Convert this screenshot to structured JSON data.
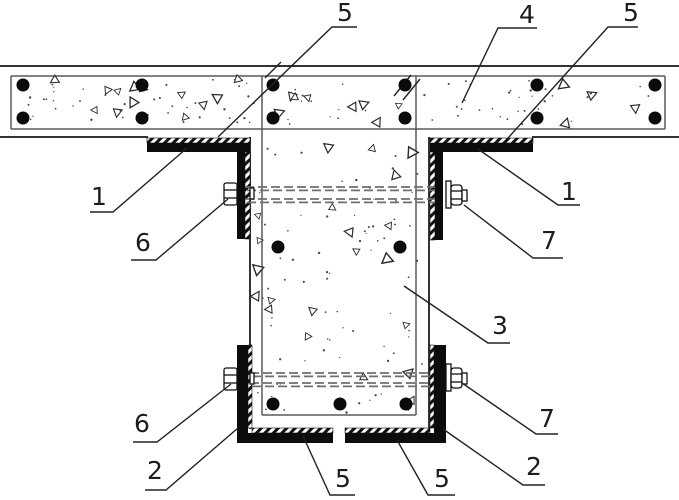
{
  "figure": {
    "kind": "patent-style structural cross-section drawing",
    "description_visible_parts": "T-joint of concrete slab and beam strengthened with steel angles, bottom channel, through-bolts and tie rods",
    "callouts": [
      {
        "label": "5",
        "tx": 345,
        "ty": 0,
        "pts": [
          [
            357,
            27
          ],
          [
            332,
            27
          ],
          [
            218,
            137
          ]
        ]
      },
      {
        "label": "4",
        "tx": 527,
        "ty": 2,
        "pts": [
          [
            537,
            28
          ],
          [
            498,
            28
          ],
          [
            462,
            103
          ]
        ]
      },
      {
        "label": "5",
        "tx": 631,
        "ty": 0,
        "pts": [
          [
            638,
            27
          ],
          [
            608,
            27
          ],
          [
            508,
            138
          ]
        ]
      },
      {
        "label": "1",
        "tx": 99,
        "ty": 184,
        "pts": [
          [
            90,
            212
          ],
          [
            113,
            212
          ],
          [
            187,
            148
          ]
        ]
      },
      {
        "label": "6",
        "tx": 143,
        "ty": 230,
        "pts": [
          [
            131,
            260
          ],
          [
            156,
            260
          ],
          [
            228,
            199
          ]
        ]
      },
      {
        "label": "1",
        "tx": 569,
        "ty": 179,
        "pts": [
          [
            580,
            205
          ],
          [
            558,
            205
          ],
          [
            478,
            149
          ]
        ]
      },
      {
        "label": "7",
        "tx": 549,
        "ty": 228,
        "pts": [
          [
            563,
            258
          ],
          [
            533,
            258
          ],
          [
            464,
            205
          ]
        ]
      },
      {
        "label": "3",
        "tx": 500,
        "ty": 313,
        "pts": [
          [
            510,
            343
          ],
          [
            488,
            343
          ],
          [
            404,
            286
          ]
        ]
      },
      {
        "label": "6",
        "tx": 142,
        "ty": 411,
        "pts": [
          [
            133,
            442
          ],
          [
            157,
            442
          ],
          [
            231,
            384
          ]
        ]
      },
      {
        "label": "2",
        "tx": 155,
        "ty": 458,
        "pts": [
          [
            145,
            490
          ],
          [
            166,
            490
          ],
          [
            238,
            428
          ]
        ]
      },
      {
        "label": "5",
        "tx": 343,
        "ty": 466,
        "pts": [
          [
            355,
            495
          ],
          [
            330,
            495
          ],
          [
            303,
            436
          ]
        ]
      },
      {
        "label": "5",
        "tx": 442,
        "ty": 466,
        "pts": [
          [
            455,
            495
          ],
          [
            428,
            495
          ],
          [
            397,
            440
          ]
        ]
      },
      {
        "label": "2",
        "tx": 534,
        "ty": 454,
        "pts": [
          [
            545,
            485
          ],
          [
            523,
            485
          ],
          [
            443,
            429
          ]
        ]
      },
      {
        "label": "7",
        "tx": 547,
        "ty": 406,
        "pts": [
          [
            558,
            434
          ],
          [
            536,
            434
          ],
          [
            462,
            383
          ]
        ]
      }
    ],
    "palette": {
      "outline": "#333333",
      "thin_line": "#5a5a5a",
      "steel": "#0c0c0c",
      "tie_rod": "#6f6f6f",
      "leader": "#222222",
      "background": "#ffffff"
    },
    "geometry_summary": {
      "canvas": {
        "w": 679,
        "h": 500
      },
      "slab": {
        "outer_top_y": 66,
        "outer_bottom_y": 137,
        "stirrup": {
          "x1": 11,
          "y1": 76,
          "x2": 665,
          "y2": 129
        }
      },
      "beam": {
        "outer_x": [
          250,
          429
        ],
        "inner_x": [
          262,
          416
        ],
        "inner_bottom_y": 415,
        "bottom_y": 428
      },
      "slab_rebar": {
        "rows_y": [
          85,
          118
        ],
        "cols_x": [
          23,
          142,
          273,
          405,
          537,
          655
        ],
        "dot_radius": 6.5
      },
      "beam_rebar": {
        "top_row": [
          [
            278,
            247
          ],
          [
            400,
            247
          ]
        ],
        "bottom_row": [
          [
            273,
            404
          ],
          [
            340,
            404
          ],
          [
            406,
            404
          ]
        ]
      },
      "top_angles": {
        "flange_y": [
          138,
          152
        ],
        "left_flange_x": [
          147,
          250
        ],
        "right_flange_x": [
          430,
          533
        ],
        "left_leg_x": [
          237,
          250
        ],
        "right_leg_x": [
          430,
          443
        ],
        "leg_bottom_y": 239
      },
      "bottom_channel": {
        "x": [
          237,
          446
        ],
        "wall_top_y": 345,
        "bottom_y": [
          428,
          443
        ],
        "center_gap_x": [
          333,
          345
        ]
      },
      "tie_rods_y": {
        "upper": [
          187,
          199
        ],
        "lower": [
          373,
          383
        ]
      },
      "bolts": {
        "upper_left": [
          230,
          194
        ],
        "upper_right": [
          454,
          195
        ],
        "lower_left": [
          230,
          379
        ],
        "lower_right": [
          454,
          377
        ]
      }
    }
  }
}
